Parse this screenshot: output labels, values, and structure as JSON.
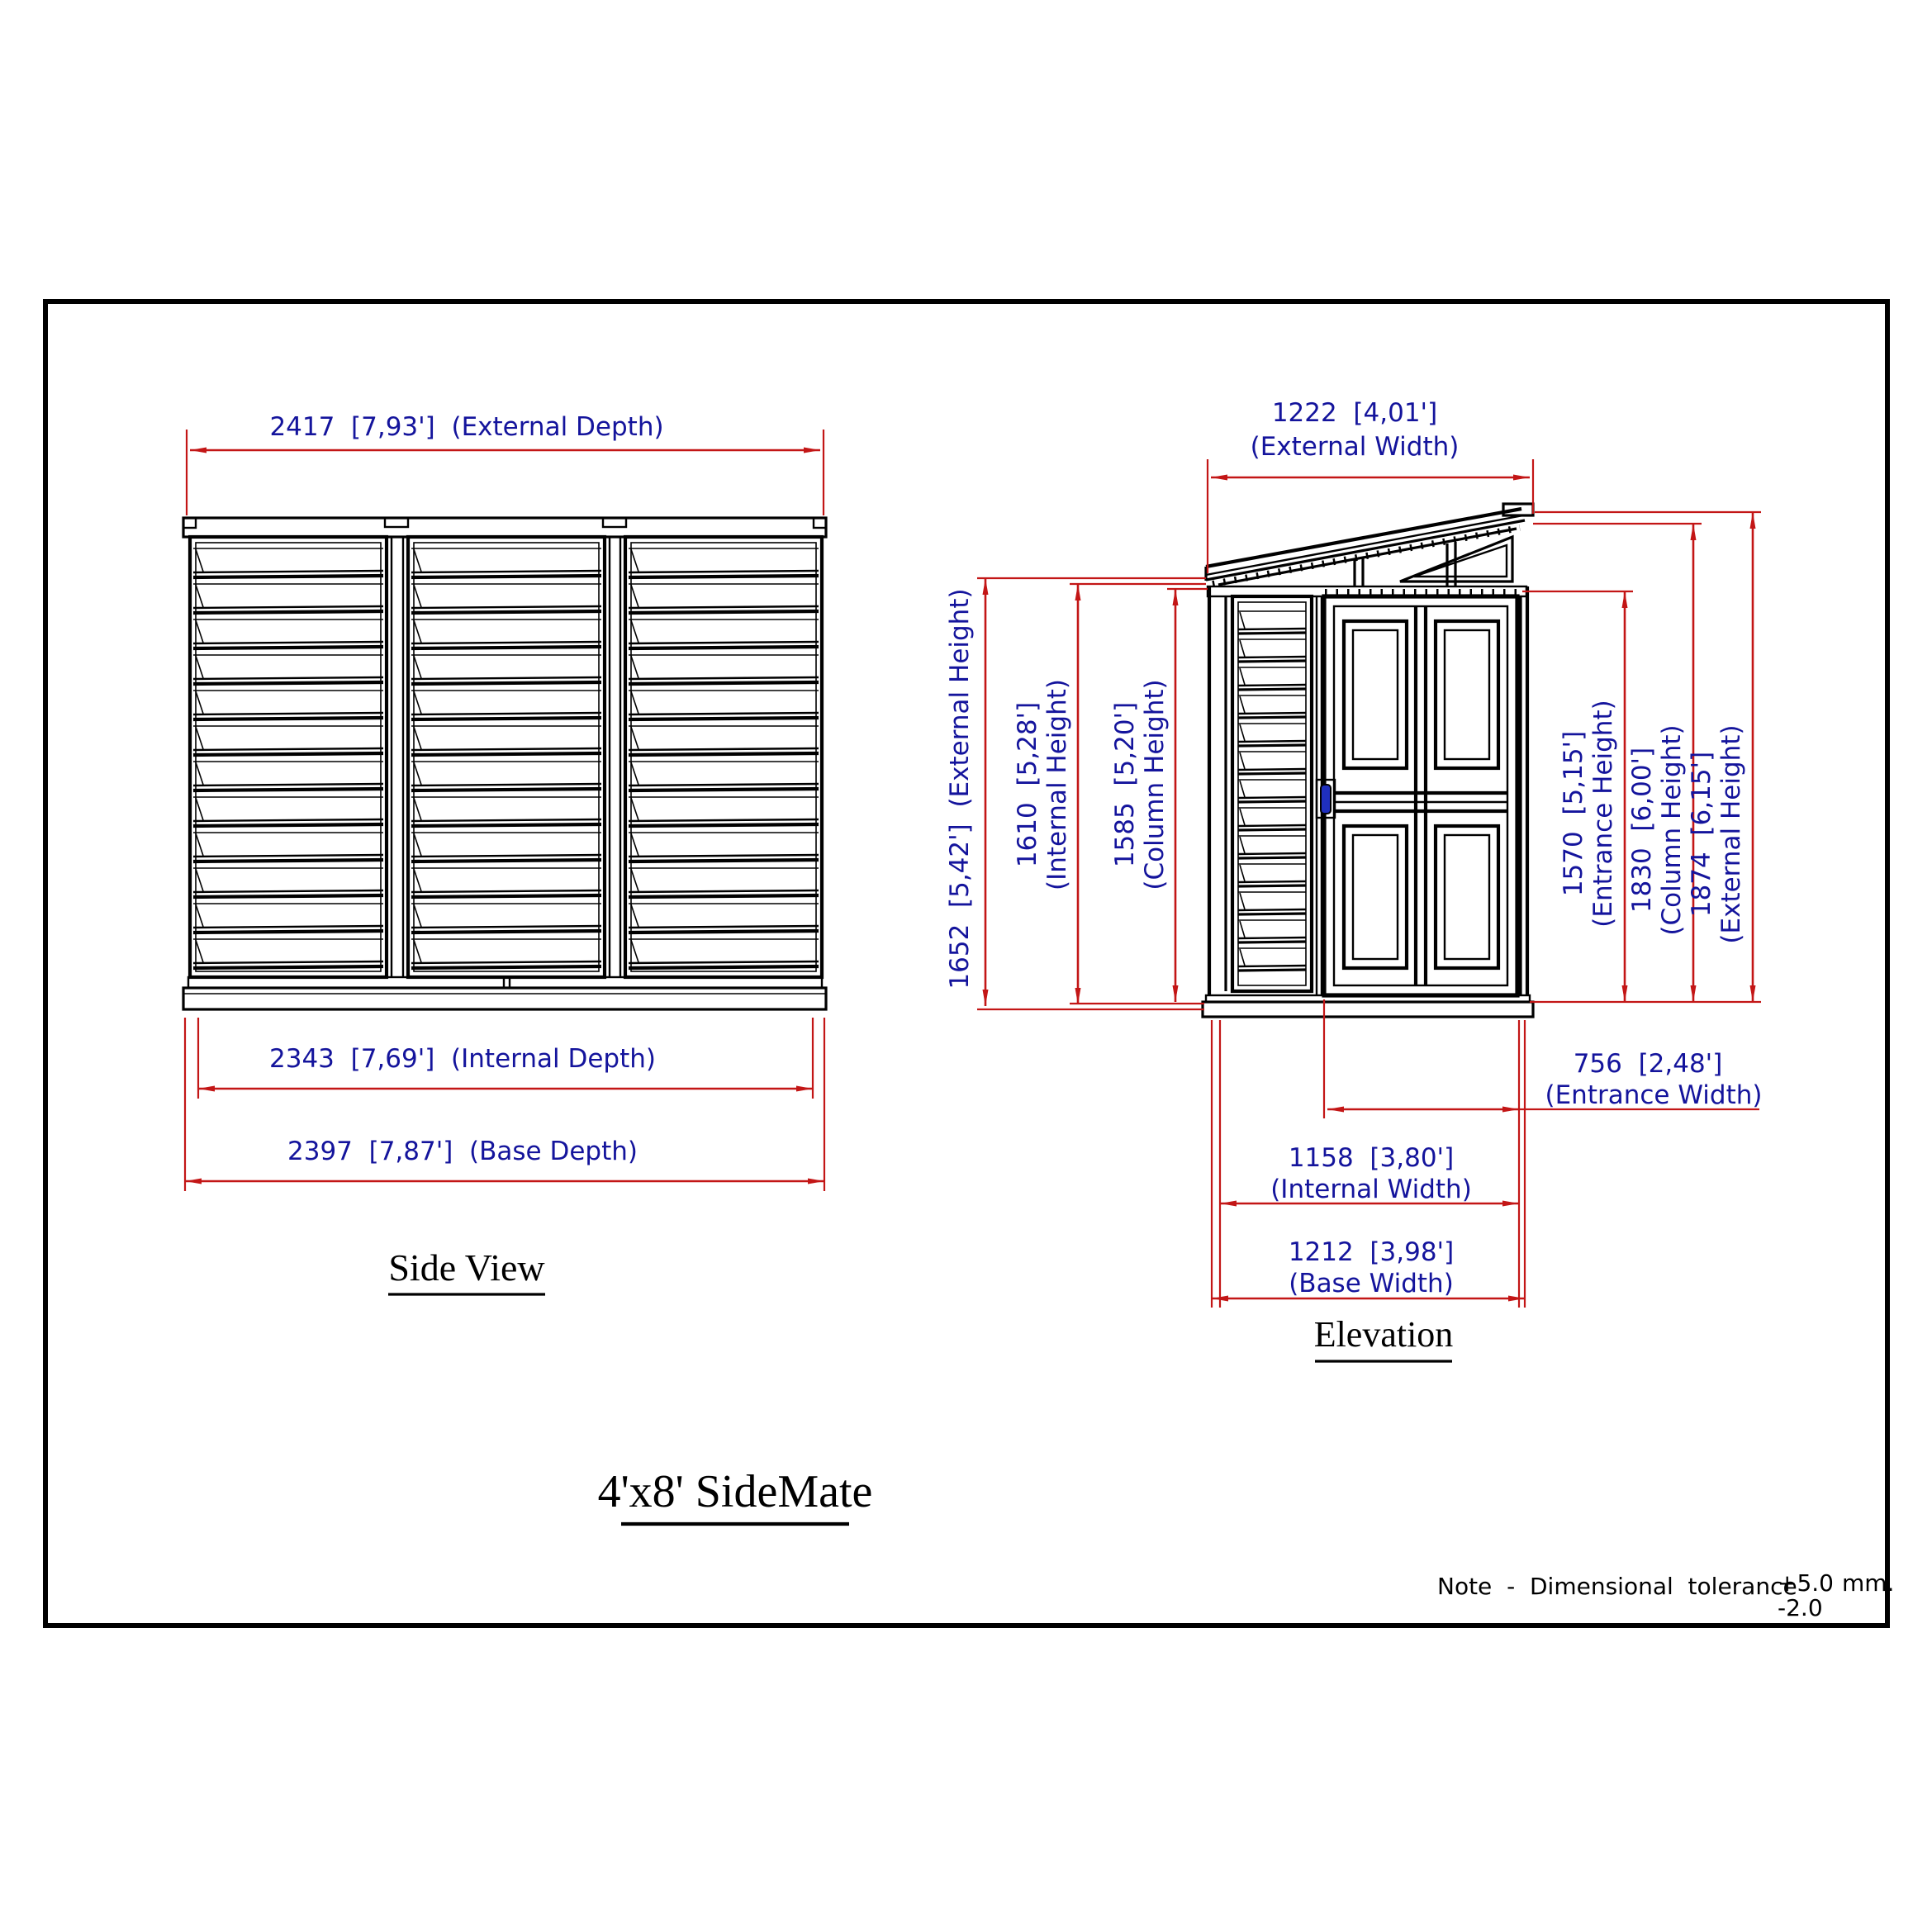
{
  "title": "4'x8' SideMate",
  "note": {
    "text": "Note  -  Dimensional  tolerance",
    "plus": "+5.0",
    "unit": "mm.",
    "minus": "-2.0"
  },
  "side_view": {
    "label": "Side View",
    "external_depth": "2417  [7,93']  (External Depth)",
    "internal_depth": "2343  [7,69']  (Internal Depth)",
    "base_depth": "2397  [7,87']  (Base Depth)"
  },
  "elevation": {
    "label": "Elevation",
    "external_width_value": "1222  [4,01']",
    "external_width_label": "(External Width)",
    "external_height_left": "1652  [5,42']  (External Height)",
    "internal_height_value": "1610  [5,28']",
    "internal_height_label": "(Internal Height)",
    "column_height_left_value": "1585  [5,20']",
    "column_height_left_label": "(Column Height)",
    "entrance_height_value": "1570  [5,15']",
    "entrance_height_label": "(Entrance Height)",
    "column_height_right_value": "1830  [6,00']",
    "column_height_right_label": "(Column Height)",
    "external_height_right_value": "1874  [6,15']",
    "external_height_right_label": "(External Height)",
    "entrance_width_value": "756  [2,48']",
    "entrance_width_label": "(Entrance Width)",
    "internal_width_value": "1158  [3,80']",
    "internal_width_label": "(Internal Width)",
    "base_width_value": "1212  [3,98']",
    "base_width_label": "(Base Width)"
  },
  "colors": {
    "dimension_line": "#c31616",
    "dimension_text": "#14149c",
    "ink": "#000000",
    "door_handle": "#1f2fbe"
  }
}
